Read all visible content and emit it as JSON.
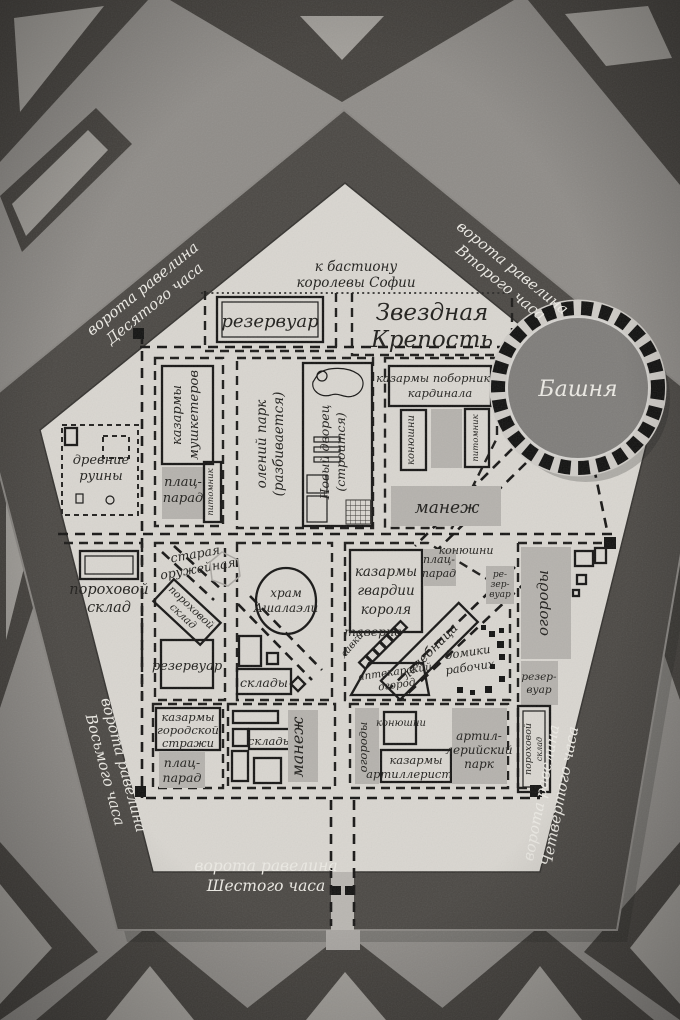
{
  "m": {
    "title": [
      "Звездная",
      "Крепость"
    ],
    "bastion_note": [
      "к бастиону",
      "королевы Софии"
    ],
    "tower": "Башня",
    "gates": {
      "tenth": [
        "ворота равелина",
        "Десятого часа"
      ],
      "second": [
        "ворота равелина",
        "Второго часа"
      ],
      "eighth": [
        "ворота равелина",
        "Восьмого часа"
      ],
      "sixth": [
        "ворота равелина",
        "Шестого часа"
      ],
      "fourth": [
        "ворота равелина",
        "Четвертого часа"
      ]
    },
    "labels": {
      "reservoir_top": "резервуар",
      "musketeers": [
        "казармы",
        "мушкетеров"
      ],
      "parade_nw": [
        "плац-",
        "парад"
      ],
      "kennel_nw": "питомник",
      "ruins": [
        "древние",
        "руины"
      ],
      "deer_park": [
        "олений парк",
        "(разбивается)"
      ],
      "new_palace": [
        "Новый дворец",
        "(строится)"
      ],
      "cardinal_barracks": [
        "казармы поборников",
        "кардинала"
      ],
      "stables_ne": "конюшни",
      "kennel_ne": "питомник",
      "manege_ne": "манеж",
      "powder_w": [
        "пороховой",
        "склад"
      ],
      "old_armory": [
        "старая",
        "оружейная"
      ],
      "powder_c": [
        "пороховой",
        "склад"
      ],
      "reservoir_c": "резервуар",
      "temple": [
        "храм",
        "Ашалаэли"
      ],
      "warehouses_c": "склады",
      "kings_guard": [
        "казармы",
        "гвардии",
        "короля"
      ],
      "parade_e": [
        "плац-",
        "парад"
      ],
      "stables_e": "конюшни",
      "reservoir_e": [
        "ре-",
        "зер-",
        "вуар"
      ],
      "tavern": "таверна",
      "shops": "лавки",
      "infirmary": "лечебница",
      "apothecary": [
        "аптекарский",
        "огород"
      ],
      "workers": [
        "домики",
        "рабочих"
      ],
      "gardens_r": "огороды",
      "reservoir_r": [
        "резер-",
        "вуар"
      ],
      "powder_r": [
        "пороховой",
        "склад"
      ],
      "city_guard": [
        "казармы",
        "городской",
        "стражи"
      ],
      "parade_s": [
        "плац-",
        "парад"
      ],
      "warehouses_s": "склады",
      "manege_s": "манеж",
      "gardens_s": "огороды",
      "stables_s": "конюшни",
      "artillery_barracks": [
        "казармы",
        "артиллеристов"
      ],
      "artillery_park": [
        "артил-",
        "лерийский",
        "парк"
      ]
    },
    "colors": {
      "paper": "#d9d6d0",
      "wall": "#4b4844",
      "outer_ground": "#8f8c88",
      "dark_shape": "#44413d",
      "light_shape": "#a09d98",
      "gray_fill": "#b5b2ad",
      "ink": "#1c1b19",
      "white_text": "#eceae4"
    }
  }
}
